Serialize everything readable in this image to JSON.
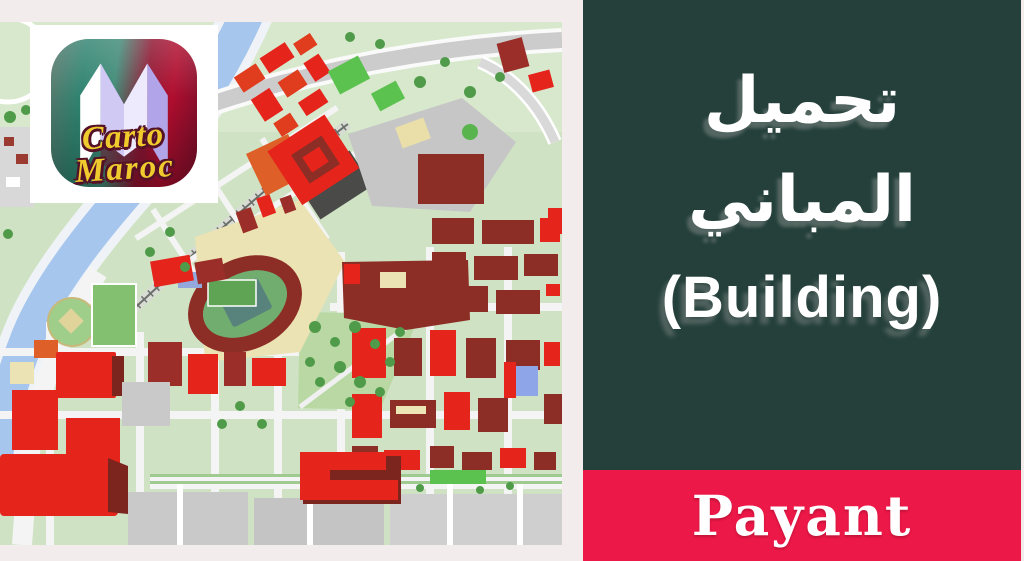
{
  "frame": {
    "background": "#F3ECEC"
  },
  "logo": {
    "line1": "Carto",
    "line2": "Maroc",
    "icon": "folded-map-m-icon",
    "icon_teal": "#2F8370",
    "icon_crimson": "#B00D2E",
    "text_color": "#F0CB2E"
  },
  "panel": {
    "background": "#25403B",
    "arabic_line1": "تحميل",
    "arabic_line2": "المباني",
    "subtitle": "(Building)",
    "text_color": "#FFFFFF"
  },
  "banner": {
    "background": "#EC1847",
    "label": "Payant",
    "text_color": "#FFFFFF"
  },
  "map_palette": {
    "base_green": "#CFE3C4",
    "park_green": "#B9D8A4",
    "tree_green": "#4F9B49",
    "river_blue": "#A6C6EE",
    "road_white": "#F4F4F4",
    "building_red": "#E5241B",
    "building_maroon": "#8C2D26",
    "building_orange": "#DE5F28",
    "block_gray": "#C6C6C6",
    "block_cream": "#EBE3B4"
  }
}
